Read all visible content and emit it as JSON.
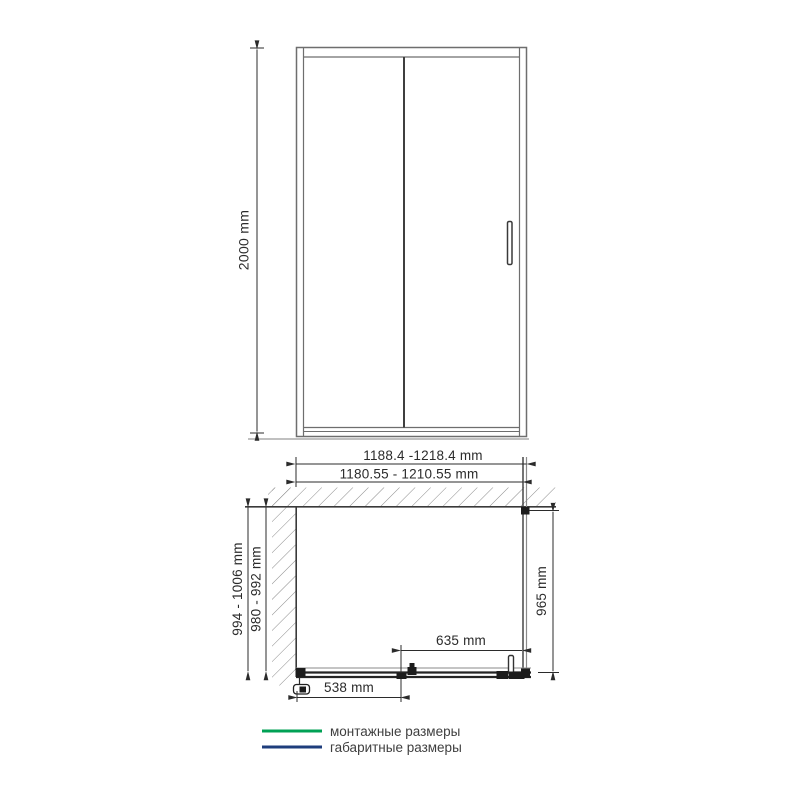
{
  "front_view": {
    "height": "2000 mm"
  },
  "plan_view": {
    "overall_width": "1188.4 -1218.4 mm",
    "mounting_width": "1180.55 - 1210.55 mm",
    "overall_depth": "994 - 1006 mm",
    "mounting_depth": "980 - 992 mm",
    "side_panel_depth": "965 mm",
    "door_width": "635 mm",
    "fixed_segment_width": "538 mm"
  },
  "legend": {
    "items": [
      {
        "label": "монтажные размеры",
        "color": "#00a155"
      },
      {
        "label": "габаритные размеры",
        "color": "#1e3d7c"
      }
    ]
  },
  "colors": {
    "drawing_line": "#2b2b2b",
    "frame_line": "#6e6e6e",
    "hatch_line": "#8a8a8a"
  }
}
